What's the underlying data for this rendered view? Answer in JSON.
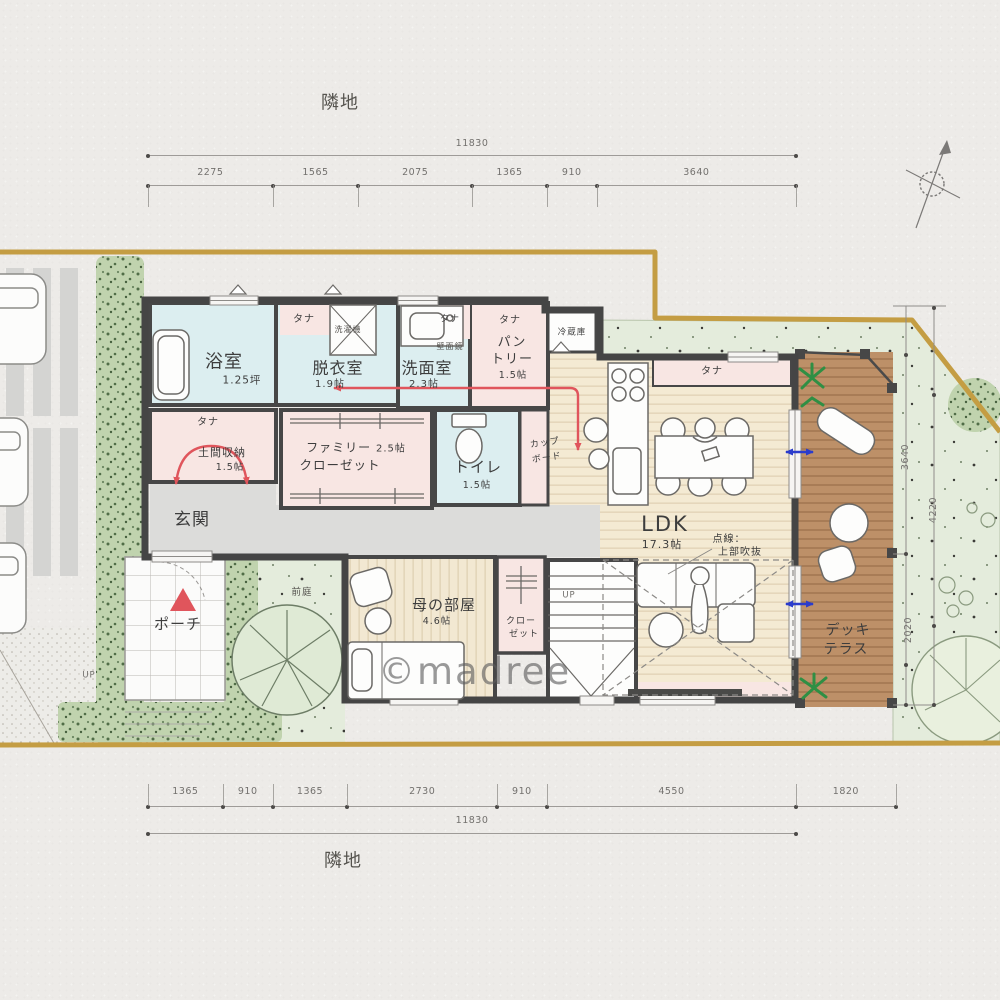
{
  "watermark": "©madree",
  "labels": {
    "neighbor": "隣地",
    "tana": "タナ",
    "up": "UP",
    "washer": "洗濯機",
    "mirror": "壁面鏡",
    "fridge": "冷蔵庫",
    "cupboard_1": "カップ",
    "cupboard_2": "ボード",
    "closet_1": "クロー",
    "closet_2": "ゼット",
    "front_garden": "前庭",
    "void_note_1": "点線：",
    "void_note_2": "上部吹抜"
  },
  "rooms": {
    "bath": {
      "name": "浴室",
      "area": "1.25坪"
    },
    "dressing": {
      "name": "脱衣室",
      "area": "1.9帖"
    },
    "washroom": {
      "name": "洗面室",
      "area": "2.3帖"
    },
    "pantry": {
      "name_1": "パン",
      "name_2": "トリー",
      "area": "1.5帖"
    },
    "toilet": {
      "name": "トイレ",
      "area": "1.5帖"
    },
    "doma": {
      "name": "土間収納",
      "area": "1.5帖"
    },
    "family_closet": {
      "name_1": "ファミリー",
      "area": "2.5帖",
      "name_2": "クローゼット"
    },
    "entrance": {
      "name": "玄関"
    },
    "porch": {
      "name": "ポーチ"
    },
    "mother": {
      "name": "母の部屋",
      "area": "4.6帖"
    },
    "ldk": {
      "name": "LDK",
      "area": "17.3帖"
    },
    "deck": {
      "name_1": "デッキ",
      "name_2": "テラス"
    }
  },
  "dimensions": {
    "top": {
      "total": "11830",
      "segments": [
        "2275",
        "1565",
        "2075",
        "1365",
        "910",
        "3640"
      ]
    },
    "bottom": {
      "total": "11830",
      "segments": [
        "1365",
        "910",
        "1365",
        "2730",
        "910",
        "4550"
      ],
      "extra": "1820"
    },
    "right": {
      "upper": "3640",
      "lower": "2020",
      "outer": "4220"
    }
  },
  "colors": {
    "boundary": "#c49d43",
    "wall": "#474747",
    "wet_room": "#dceef0",
    "storage_pink": "#f8e6e3",
    "wood": "#f4ead3",
    "deck": "#bd9068",
    "grass": "#e4ecdc",
    "flow_arrow": "#e0555c",
    "door_arrow": "#2b3ccc"
  }
}
